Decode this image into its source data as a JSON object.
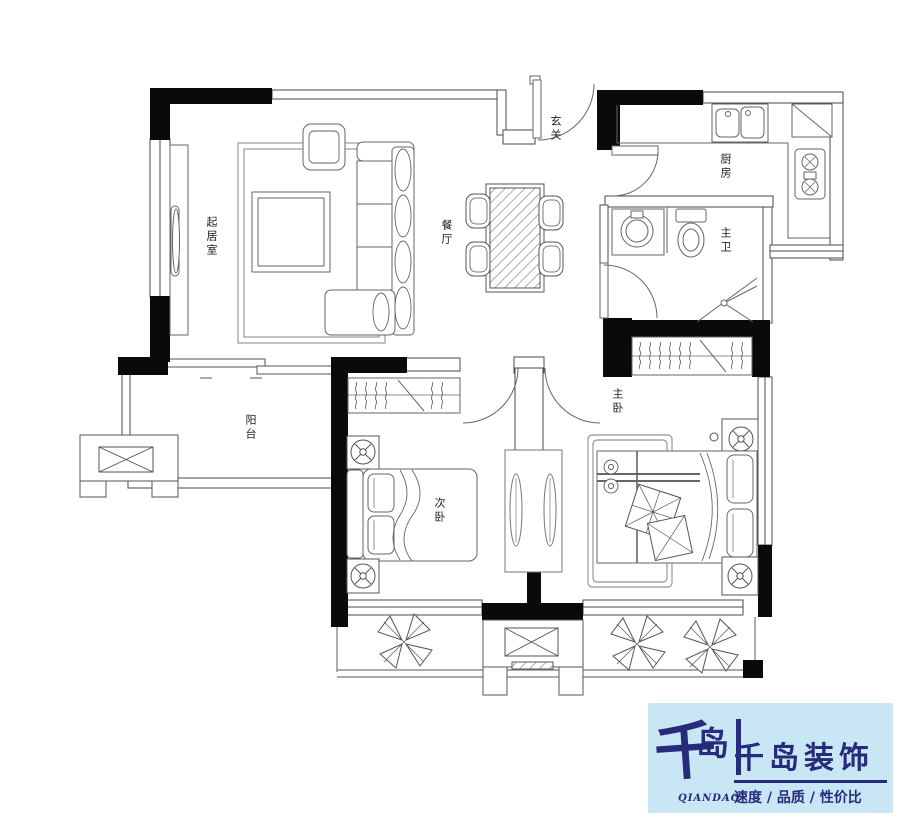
{
  "rooms": [
    {
      "id": "living-room",
      "label": "起居室"
    },
    {
      "id": "dining",
      "label": "餐厅"
    },
    {
      "id": "entry",
      "label": "玄关"
    },
    {
      "id": "kitchen",
      "label": "厨房"
    },
    {
      "id": "master-bath",
      "label": "主卫"
    },
    {
      "id": "balcony",
      "label": "阳台"
    },
    {
      "id": "second-bedroom",
      "label": "次卧"
    },
    {
      "id": "master-bedroom",
      "label": "主卧"
    }
  ],
  "logo": {
    "mark_char_1": "千",
    "mark_char_2": "岛",
    "mark_caption": "QIANDAO",
    "company_name": "千岛装饰",
    "tagline": "速度 / 品质 / 性价比",
    "bg_color": "#c9e6f4",
    "text_color": "#262b7b"
  },
  "colors": {
    "background": "#ffffff",
    "wall_black": "#0a0a0a",
    "line_gray": "#555555"
  }
}
